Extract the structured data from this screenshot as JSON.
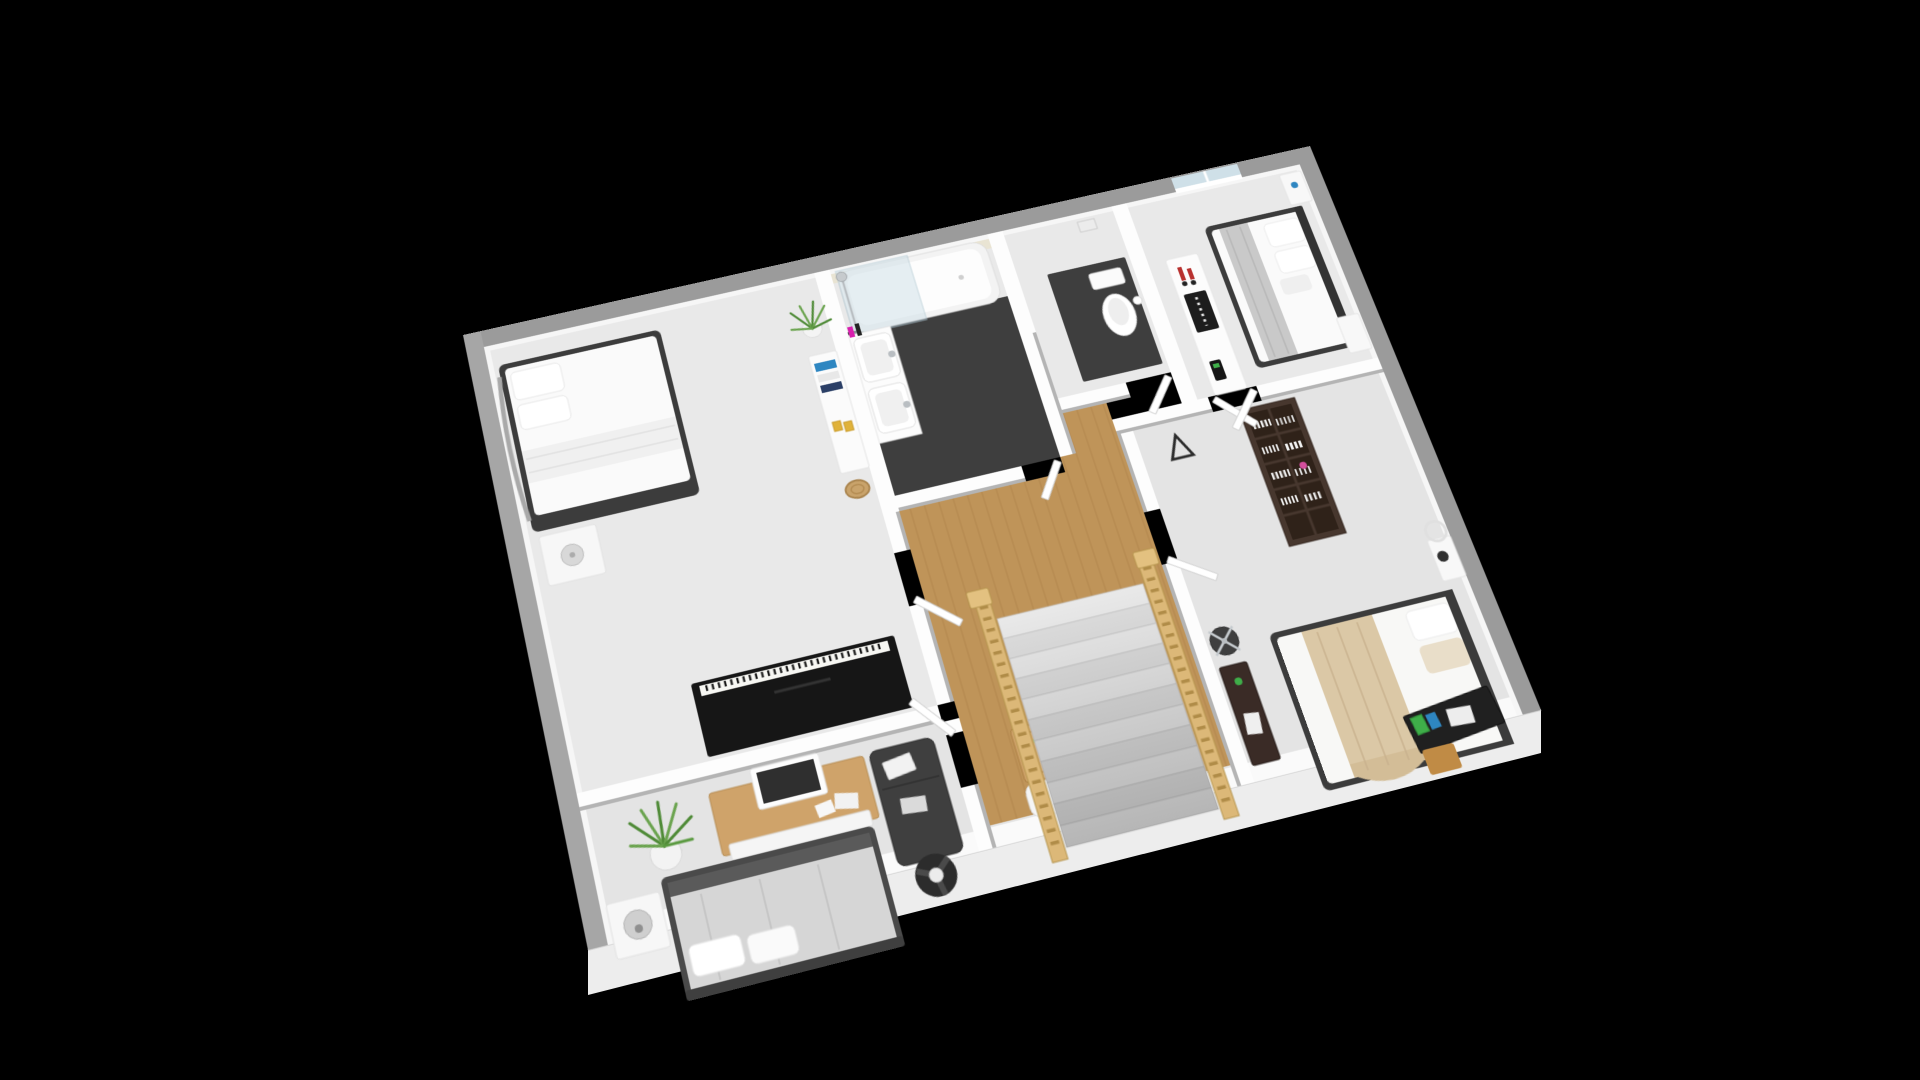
{
  "scene": {
    "type": "isometric-3d-floor-plan-render",
    "background": "#000000",
    "floor": "upper-floor",
    "rooms": [
      {
        "id": "bedroom-top-left",
        "floor_material": "carpet",
        "furniture": [
          "double-bed-white",
          "curved-headboard",
          "nightstand",
          "round-table-lamp",
          "upright-piano",
          "dresser",
          "decor-books",
          "grass-plant",
          "woven-basket"
        ]
      },
      {
        "id": "bathroom",
        "floor_material": "dark-tile",
        "furniture": [
          "bathtub",
          "glass-shower-screen",
          "shower-column",
          "vanity-counter",
          "basin",
          "basin",
          "toiletry-bottles"
        ]
      },
      {
        "id": "wc",
        "floor_material": "dark-tile-platform",
        "furniture": [
          "toilet",
          "wall-frame",
          "paper-roll"
        ]
      },
      {
        "id": "bedroom-top-right",
        "floor_material": "carpet",
        "furniture": [
          "double-bed-white-gray-blanket",
          "headboard",
          "nightstand",
          "nightstand",
          "console-sideboard",
          "black-tray",
          "red-candles",
          "phone"
        ]
      },
      {
        "id": "bedroom-right",
        "floor_material": "carpet",
        "furniture": [
          "double-bed-beige-blanket",
          "bookshelf-dark",
          "books",
          "nightstand",
          "round-mirror",
          "small-lamp",
          "vanity-desk-dark",
          "swivel-chair-chrome",
          "media-desk-dark",
          "colorful-books",
          "papers",
          "wood-stool",
          "easel-triangle"
        ]
      },
      {
        "id": "bedroom-bottom-left",
        "floor_material": "carpet",
        "furniture": [
          "desk-wood",
          "monitor",
          "papers",
          "desk-chair-white",
          "large-grass-plant",
          "nightstand",
          "dome-lamp",
          "gray-double-bed",
          "pillows",
          "daybed-sofa-dark",
          "white-books",
          "floor-fan"
        ]
      },
      {
        "id": "landing-hall",
        "floor_material": "oak-wood",
        "furniture": [
          "staircase",
          "pine-railing-left",
          "pine-railing-right",
          "newel-posts",
          "slatted-wood-bench",
          "coffee-table",
          "flower-pot",
          "white-stool"
        ]
      }
    ],
    "openings": [
      "window-top-wall",
      "door-bathroom",
      "door-wc",
      "double-door-bedroom-top-right",
      "door-bedroom-top-left",
      "door-bedroom-bottom-left",
      "door-bedroom-right"
    ]
  },
  "colors": {
    "background": "#000000",
    "outer_wall": "#9b9b9b",
    "outer_wall_light": "#a6a6a6",
    "inner_wall": "#fdfdfd",
    "inner_face": "#f6f6f6",
    "wall_cap": "#b4b4b4",
    "carpet": "#e9e9e9",
    "carpet_dim": "#e4e4e4",
    "wood_floor": "#bf9459",
    "wood_plank_line": "#a87c44",
    "dark_floor": "#3e3e3e",
    "tile_cream": "#e9e4d3",
    "front_band": "#fafafa",
    "fascia": "#ededed",
    "glass": "#cfe0e8",
    "dark_furniture": "#3c3c3c",
    "bed_white": "#fafafa",
    "blanket_gray": "#c9c9c9",
    "blanket_beige": "#dbc8a6",
    "piano_black": "#161616",
    "keys_white": "#f7f7f3",
    "shelf_brown": "#47372e",
    "desk_wood": "#cfa36a",
    "bench_wood": "#c08b45",
    "rail_wood": "#dcb878",
    "plant_green": "#4e8a36",
    "plant_green_light": "#6aa34e",
    "accent_red": "#b8312f",
    "accent_green": "#3fae49",
    "accent_blue": "#2e86c1",
    "accent_magenta": "#d81fae",
    "chrome": "#b9bec2",
    "step_light": "#e9e9e9",
    "step_dark": "#dedede"
  }
}
